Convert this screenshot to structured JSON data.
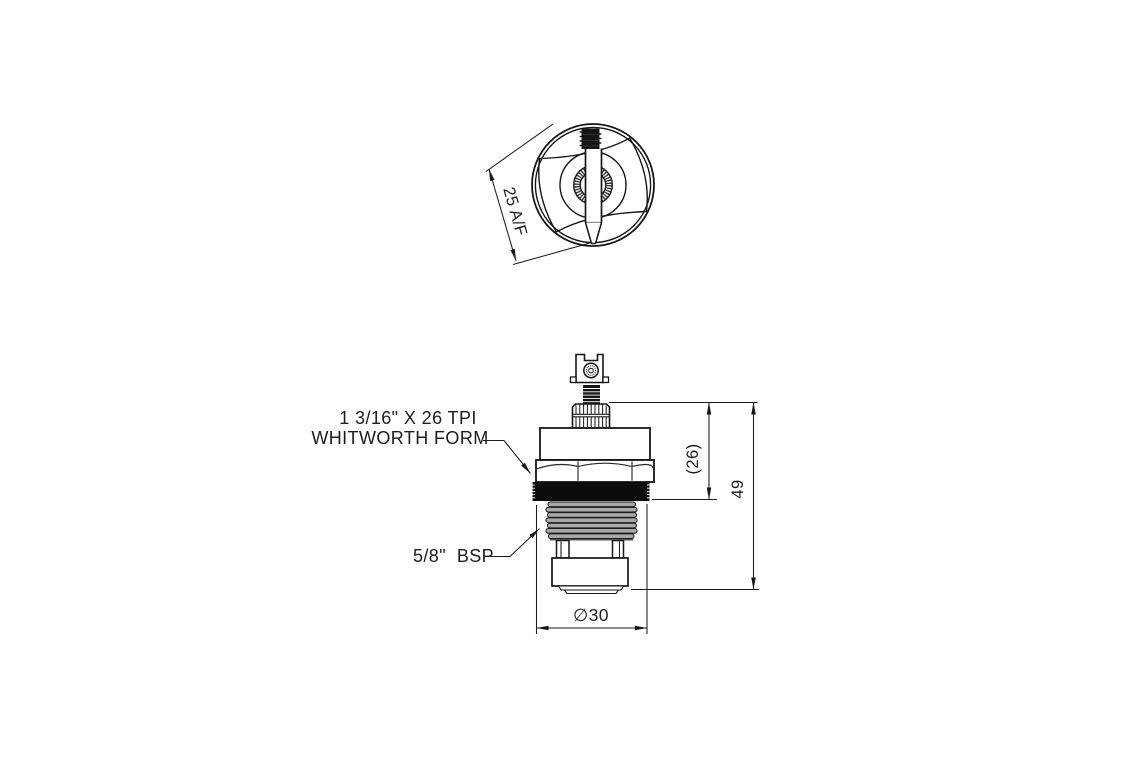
{
  "drawing": {
    "top_view": {
      "dim_across_flats": "25 A/F"
    },
    "front_view": {
      "thread_spec_line1": "1 3/16\" X 26 TPI",
      "thread_spec_line2": "WHITWORTH FORM",
      "bsp_label": "5/8\"  BSP",
      "dim_upper_height": "(26)",
      "dim_overall_height": "49",
      "dim_base_diameter": "∅30"
    },
    "colors": {
      "line": "#1c1c1c",
      "seal_black": "#0c0c0c",
      "thread_grey": "#a9a9a9",
      "background": "#ffffff"
    }
  }
}
